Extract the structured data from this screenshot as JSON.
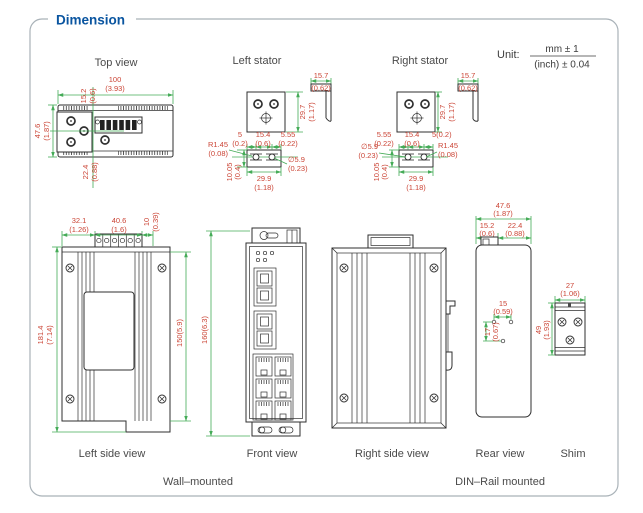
{
  "header": {
    "title": "Dimension"
  },
  "unit": {
    "label": "Unit:",
    "mm": "mm ± 1",
    "inch": "(inch) ± 0.04"
  },
  "top_view": {
    "label": "Top view",
    "w_mm": "100",
    "w_in": "(3.93)",
    "off_mm": "15.2",
    "off_in": "(0.6)",
    "h_mm": "47.6",
    "h_in": "(1.87)",
    "b_mm": "22.4",
    "b_in": "(0.88)"
  },
  "left_stator": {
    "label": "Left stator",
    "ph_mm": "29.7",
    "ph_in": "(1.17)",
    "fl_mm": "15.7",
    "fl_in": "(0.62)",
    "e1_mm": "5",
    "e1_in": "(0.2)",
    "p_mm": "15.4",
    "p_in": "(0.6)",
    "e2_mm": "5.55",
    "e2_in": "(0.22)",
    "r_mm": "R1.45",
    "r_in": "(0.08)",
    "d_mm": "∅5.9",
    "d_in": "(0.23)",
    "bw_mm": "29.9",
    "bw_in": "(1.18)",
    "bh_mm": "10.05",
    "bh_in": "(0.4)"
  },
  "right_stator": {
    "label": "Right stator",
    "ph_mm": "29.7",
    "ph_in": "(1.17)",
    "fl_mm": "15.7",
    "fl_in": "(0.62)",
    "e2_mm": "5.55",
    "e2_in": "(0.22)",
    "p_mm": "15.4",
    "p_in": "(0.6)",
    "e1": "5(0.2)",
    "d_mm": "∅5.9",
    "d_in": "(0.23)",
    "r_mm": "R1.45",
    "r_in": "(0.08)",
    "bw_mm": "29.9",
    "bw_in": "(1.18)",
    "bh_mm": "10.05",
    "bh_in": "(0.4)"
  },
  "left_side": {
    "label": "Left side view",
    "d1_mm": "32.1",
    "d1_in": "(1.26)",
    "d2_mm": "40.6",
    "d2_in": "(1.6)",
    "d3_mm": "10",
    "d3_in": "(0.39)",
    "h_mm": "181.4",
    "h_in": "(7.14)",
    "ih": "150(5.9)"
  },
  "front": {
    "label": "Front view",
    "h": "160(6.3)"
  },
  "right_side": {
    "label": "Right side view"
  },
  "rear": {
    "label": "Rear view",
    "w_mm": "47.6",
    "w_in": "(1.87)",
    "w1_mm": "15.2",
    "w1_in": "(0.6)",
    "w2_mm": "22.4",
    "w2_in": "(0.88)",
    "hs_mm": "15",
    "hs_in": "(0.59)",
    "hv_mm": "17",
    "hv_in": "(0.67)"
  },
  "shim": {
    "label": "Shim",
    "w_mm": "27",
    "w_in": "(1.06)",
    "h_mm": "49",
    "h_in": "(1.93)"
  },
  "captions": {
    "wall": "Wall–mounted",
    "din": "DIN–Rail mounted"
  }
}
